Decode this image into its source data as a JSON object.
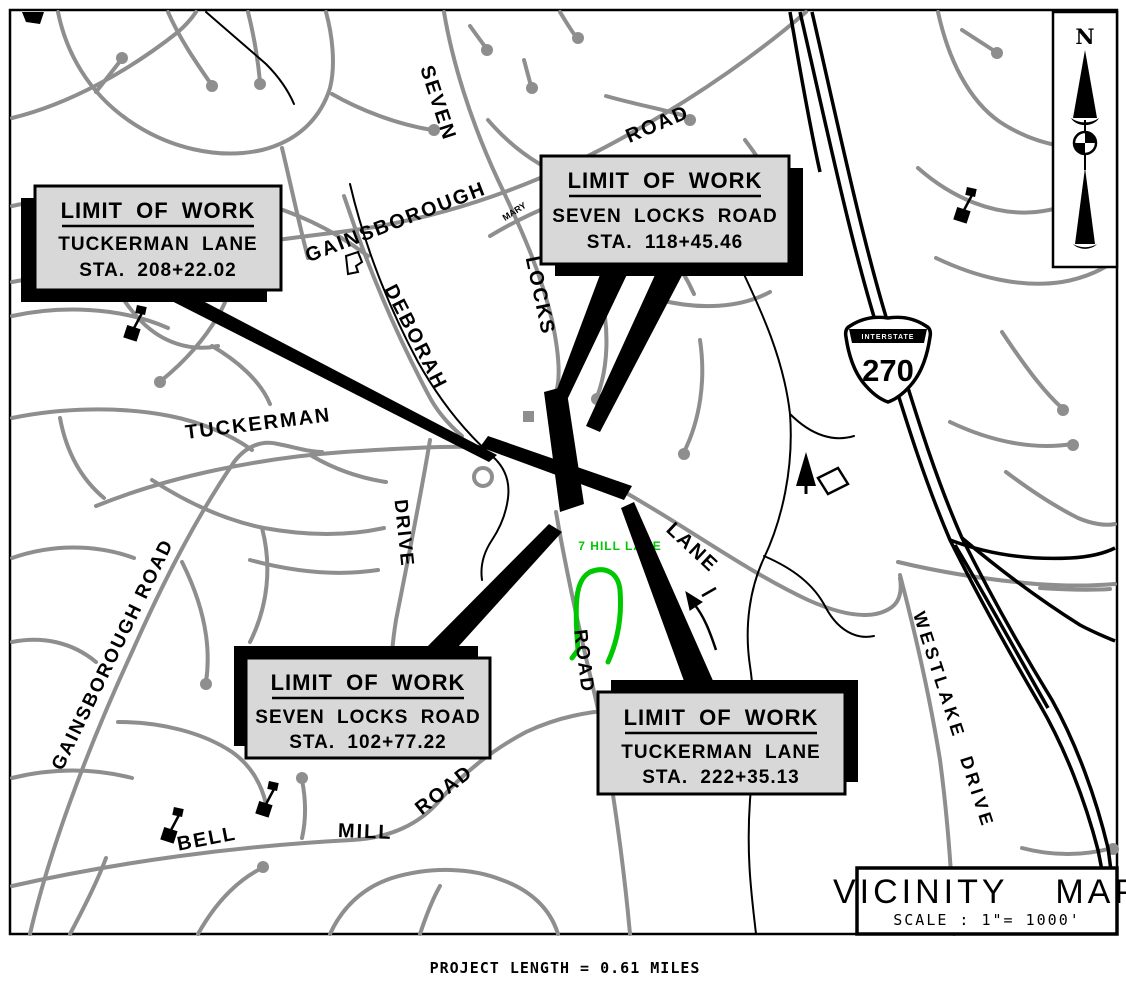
{
  "colors": {
    "road_gray": "#8e8e8e",
    "work_black": "#000000",
    "callout_fill": "#d8d8d8",
    "highlight_green": "#00c800",
    "background": "#ffffff"
  },
  "callouts": [
    {
      "title": "LIMIT OF WORK",
      "road": "TUCKERMAN LANE",
      "station": "STA. 208+22.02"
    },
    {
      "title": "LIMIT OF WORK",
      "road": "SEVEN LOCKS ROAD",
      "station": "STA. 118+45.46"
    },
    {
      "title": "LIMIT OF WORK",
      "road": "SEVEN LOCKS ROAD",
      "station": "STA. 102+77.22"
    },
    {
      "title": "LIMIT OF WORK",
      "road": "TUCKERMAN LANE",
      "station": "STA. 222+35.13"
    }
  ],
  "road_labels": {
    "seven": "SEVEN",
    "locks": "LOCKS",
    "road_top": "ROAD",
    "road_seven_locks": "ROAD",
    "gainsborough": "GAINSBOROUGH",
    "mary": "MARY",
    "deborah": "DEBORAH",
    "drive": "DRIVE",
    "tuckerman": "TUCKERMAN",
    "lane": "LANE",
    "gainsborough_road": "GAINSBOROUGH ROAD",
    "bell": "BELL",
    "mill": "MILL",
    "road_bell_mill": "ROAD",
    "westlake_drive": "WESTLAKE DRIVE",
    "hill_lane": "7 HILL LANE"
  },
  "interstate": {
    "word": "INTERSTATE",
    "number": "270"
  },
  "north_arrow": {
    "label": "N"
  },
  "title_block": {
    "title": "VICINITY MAP",
    "scale": "SCALE : 1\"= 1000'"
  },
  "footer": {
    "project_length": "PROJECT LENGTH = 0.61 MILES"
  }
}
